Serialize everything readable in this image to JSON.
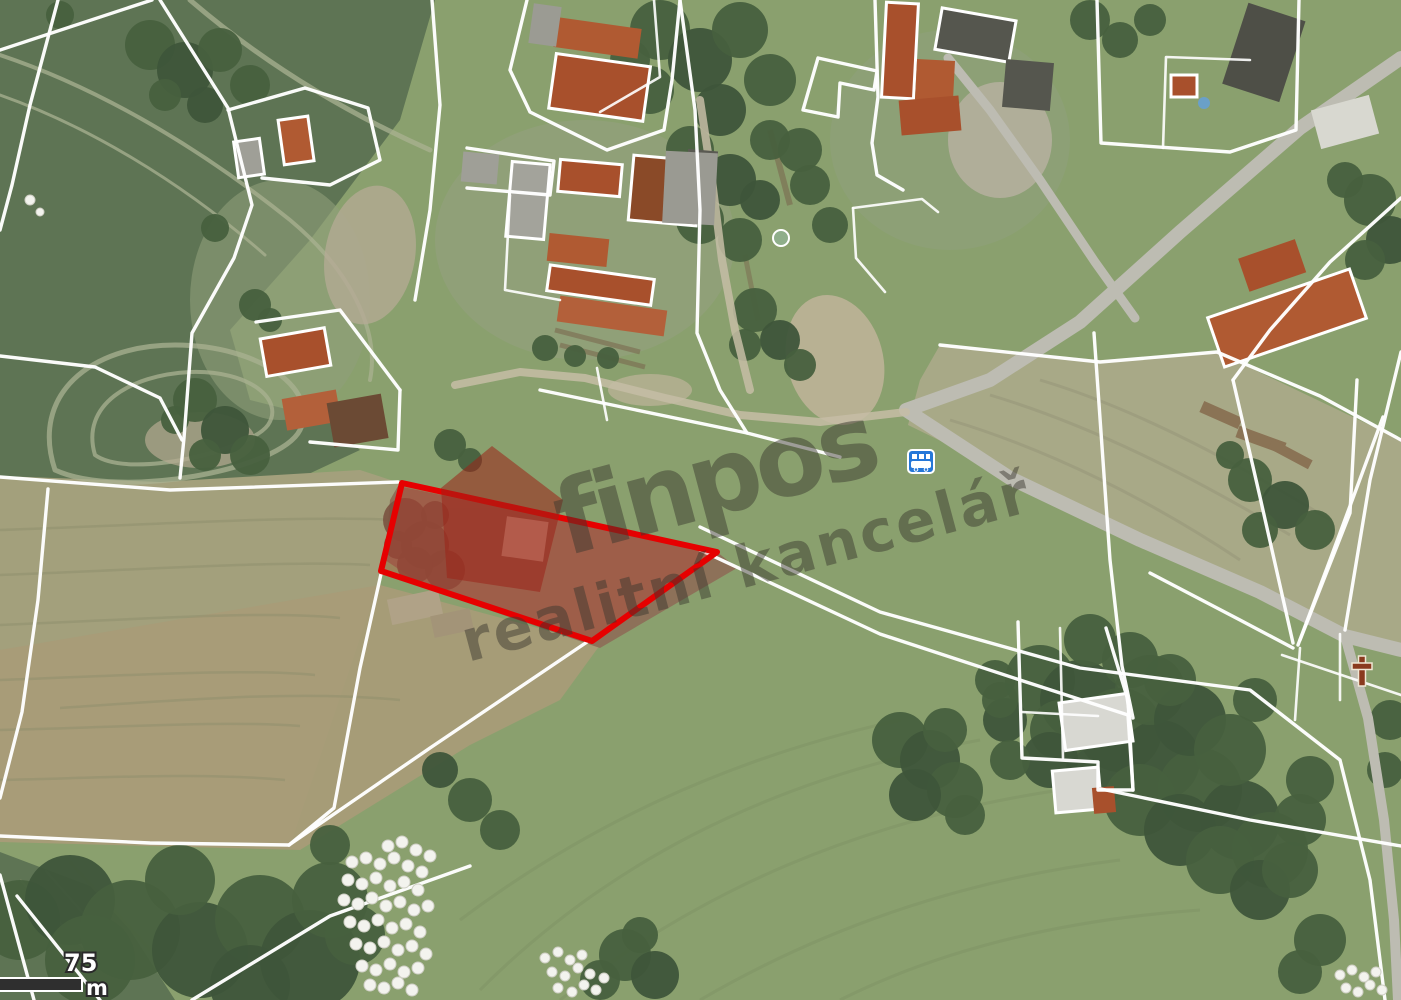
{
  "page": {
    "title": "Aerial cadastral map with highlighted parcel"
  },
  "watermark": {
    "brand": "finpos",
    "tagline": "realitní kancelář",
    "logo_color": "#9c2318",
    "text_color": "#3a382f"
  },
  "scalebar": {
    "value": "75",
    "unit": "m"
  },
  "parcel": {
    "points": "402,483 717,552 592,641 381,571",
    "stroke_color": "#e60000",
    "fill_opacity": 0.25
  },
  "icons": {
    "bus_stop": {
      "name": "bus-stop-icon",
      "color": "#2577d8"
    },
    "wayside_cross": {
      "name": "wayside-cross-icon",
      "color": "#8a3a1e"
    }
  },
  "map_colors": {
    "cadastral_line": "#ffffff",
    "field_dark_green": "#5e7454",
    "field_pale_olive": "#a3a07c",
    "field_tan": "#a89b78",
    "field_base_green": "#8aa06e",
    "forest_green": "#47603e",
    "road_gray": "#bdbcb2",
    "plowed_brown": "#8d7159",
    "roof_red": "#a8502c",
    "roof_gray": "#9b9b93"
  }
}
